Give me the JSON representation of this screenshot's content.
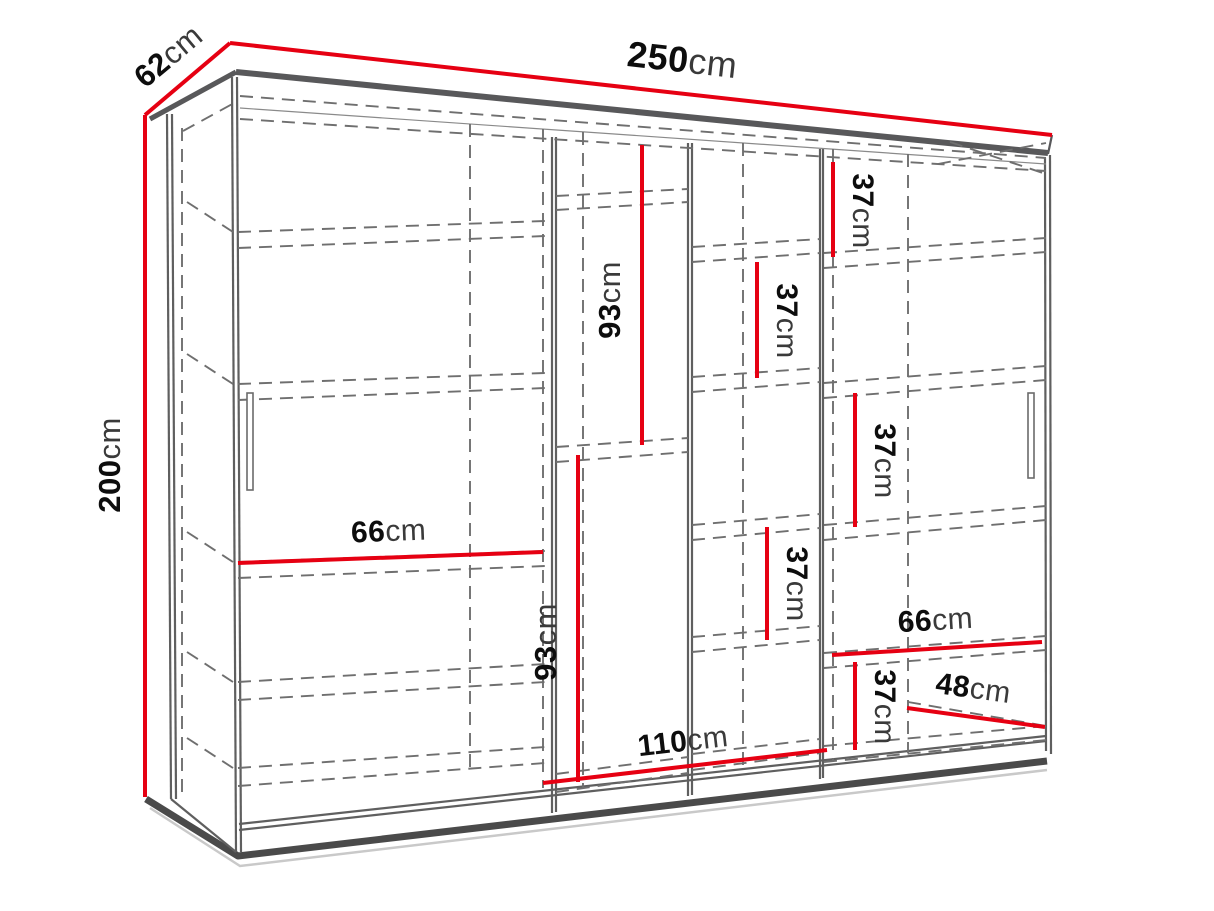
{
  "diagram": {
    "kind": "furniture dimension line drawing",
    "subject": "three-door sliding wardrobe with internal shelves, shown in perspective with red measurement lines"
  },
  "colors": {
    "background": "#ffffff",
    "dimension_line": "#e60012",
    "outline": "#58585a",
    "dashed_line": "#6f6f6f",
    "label_number": "#0d0d0d",
    "label_unit": "#3a3a3a"
  },
  "dimensions": [
    {
      "id": "overall-width",
      "value": "250",
      "unit": "cm"
    },
    {
      "id": "overall-depth",
      "value": "62",
      "unit": "cm"
    },
    {
      "id": "overall-height",
      "value": "200",
      "unit": "cm"
    },
    {
      "id": "hanging-height-upper",
      "value": "93",
      "unit": "cm"
    },
    {
      "id": "hanging-height-lower",
      "value": "93",
      "unit": "cm"
    },
    {
      "id": "shelf-gap-right-top",
      "value": "37",
      "unit": "cm"
    },
    {
      "id": "shelf-gap-middle-upper",
      "value": "37",
      "unit": "cm"
    },
    {
      "id": "shelf-gap-right-middle",
      "value": "37",
      "unit": "cm"
    },
    {
      "id": "shelf-gap-middle-lower",
      "value": "37",
      "unit": "cm"
    },
    {
      "id": "shelf-gap-right-bottom",
      "value": "37",
      "unit": "cm"
    },
    {
      "id": "left-section-width",
      "value": "66",
      "unit": "cm"
    },
    {
      "id": "right-section-width",
      "value": "66",
      "unit": "cm"
    },
    {
      "id": "middle-section-width",
      "value": "110",
      "unit": "cm"
    },
    {
      "id": "interior-depth",
      "value": "48",
      "unit": "cm"
    }
  ]
}
